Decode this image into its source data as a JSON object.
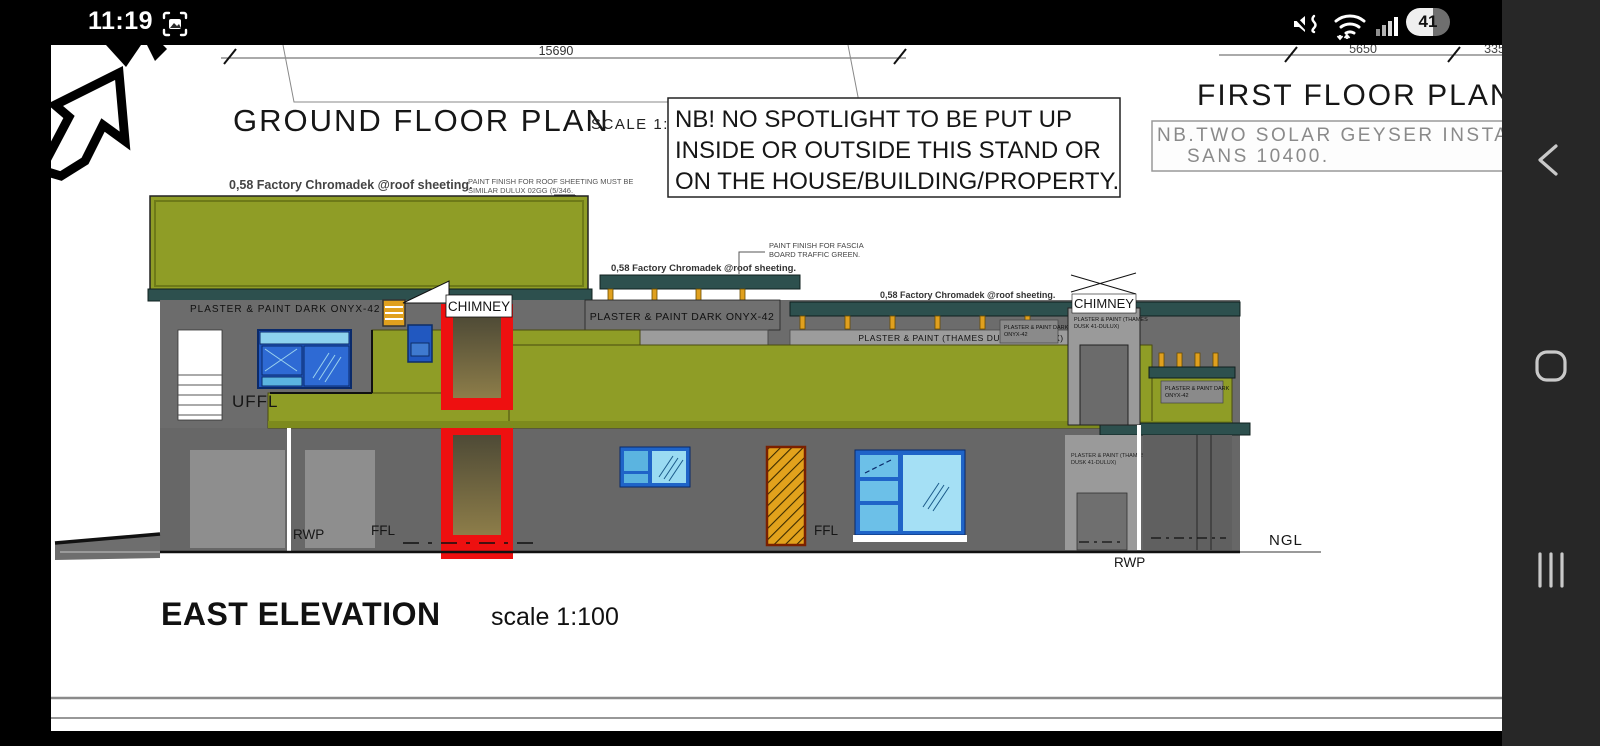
{
  "status_bar": {
    "time": "11:19",
    "battery": "41",
    "icons": [
      "screenshot-icon",
      "mute-icon",
      "wifi-icon",
      "signal-icon",
      "battery-indicator"
    ]
  },
  "nav_bar": {
    "back": "back-button",
    "home": "home-button",
    "recents": "recents-button"
  },
  "drawing": {
    "headings": {
      "ground_floor_plan": "GROUND FLOOR PLAN",
      "ground_floor_scale": "SCALE 1:100",
      "first_floor_plan": "FIRST FLOOR PLAN",
      "east_elevation": "EAST ELEVATION",
      "east_elevation_scale": "scale 1:100"
    },
    "notes": {
      "spotlight_line1": "NB! NO SPOTLIGHT TO BE PUT UP",
      "spotlight_line2": "INSIDE OR OUTSIDE THIS STAND OR",
      "spotlight_line3": "ON THE HOUSE/BUILDING/PROPERTY.",
      "solar_line1": "NB.TWO SOLAR GEYSER INSTALL",
      "solar_line2": "SANS 10400.",
      "roof_paint_line1": "PAINT FINISH FOR ROOF SHEETING MUST BE",
      "roof_paint_line2": "SIMILAR DULUX 02GG (5/346.",
      "fascia_line1": "PAINT FINISH FOR FASCIA",
      "fascia_line2": "BOARD TRAFFIC GREEN."
    },
    "dimensions": {
      "span_main": "15690",
      "span_a": "5650",
      "span_b": "3350"
    },
    "labels": {
      "roof_sheeting": "0,58 Factory Chromadek @roof sheeting.",
      "plaster_onyx": "PLASTER & PAINT DARK ONYX-42",
      "plaster_onyx_line1": "PLASTER & PAINT DARK",
      "plaster_onyx_line2": "ONYX-42",
      "plaster_thames": "PLASTER & PAINT (THAMES DUSK 41-DULUX)",
      "plaster_thames_line1": "PLASTER & PAINT (THAMES",
      "plaster_thames_line2": "DUSK 41-DULUX)",
      "chimney": "CHIMNEY",
      "uffl": "UFFL",
      "ffl": "FFL",
      "rwp": "RWP",
      "ngl": "NGL"
    },
    "colors": {
      "roof_green": "#8f9d26",
      "green_edge": "#6e7a18",
      "fascia_teal": "#2d504e",
      "wall_dark": "#6c6c6c",
      "wall_light": "#9a9a9a",
      "chimney_red": "#ee1010",
      "window_frame_blue": "#1f64c8",
      "pane_light_blue": "#9adbf2",
      "door_orange": "#e2a21c",
      "post_yellow": "#e0a01e"
    }
  }
}
